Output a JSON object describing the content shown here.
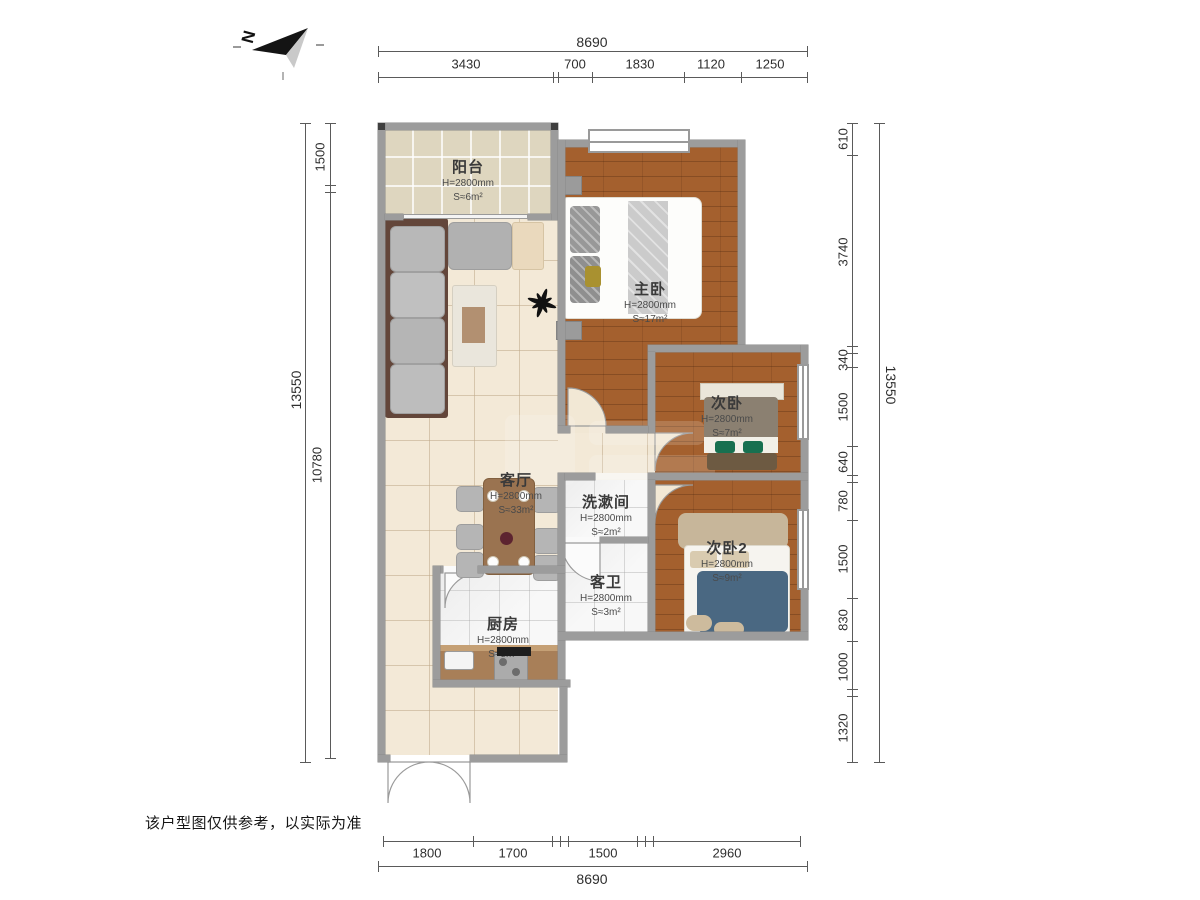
{
  "north": {
    "label": "N"
  },
  "disclaimer": "该户型图仅供参考，以实际为准",
  "rooms": [
    {
      "name": "阳台",
      "height": "H=2800mm",
      "area": "S≈6m²"
    },
    {
      "name": "主卧",
      "height": "H=2800mm",
      "area": "S≈17m²"
    },
    {
      "name": "次卧",
      "height": "H=2800mm",
      "area": "S≈7m²"
    },
    {
      "name": "次卧2",
      "height": "H=2800mm",
      "area": "S≈9m²"
    },
    {
      "name": "客厅",
      "height": "H=2800mm",
      "area": "S≈33m²"
    },
    {
      "name": "洗漱间",
      "height": "H=2800mm",
      "area": "S≈2m²"
    },
    {
      "name": "客卫",
      "height": "H=2800mm",
      "area": "S≈3m²"
    },
    {
      "name": "厨房",
      "height": "H=2800mm",
      "area": "S≈5m²"
    }
  ],
  "dimensions": {
    "top_total": "8690",
    "top_segments": [
      "3430",
      "700",
      "1830",
      "1120",
      "1250"
    ],
    "bottom_segments": [
      "1800",
      "1700",
      "1500",
      "2960"
    ],
    "bottom_total": "8690",
    "left_total": "13550",
    "left_segments": [
      "1500",
      "10780"
    ],
    "right_total": "13550",
    "right_segments": [
      "610",
      "3740",
      "340",
      "1500",
      "640",
      "780",
      "1500",
      "830",
      "1000",
      "1320"
    ]
  },
  "colors": {
    "wall": "#9c9c9c",
    "wood": "#a4602e",
    "tile": "#f3e9d7",
    "balconyTile": "#ded6bf",
    "marble": "#f8f8f8",
    "swing": "#f2e8d5",
    "accentBlanket": "#4a6882",
    "counter": "#a87f58",
    "dimLine": "#5a5a5a",
    "text": "#2e2e2e"
  }
}
